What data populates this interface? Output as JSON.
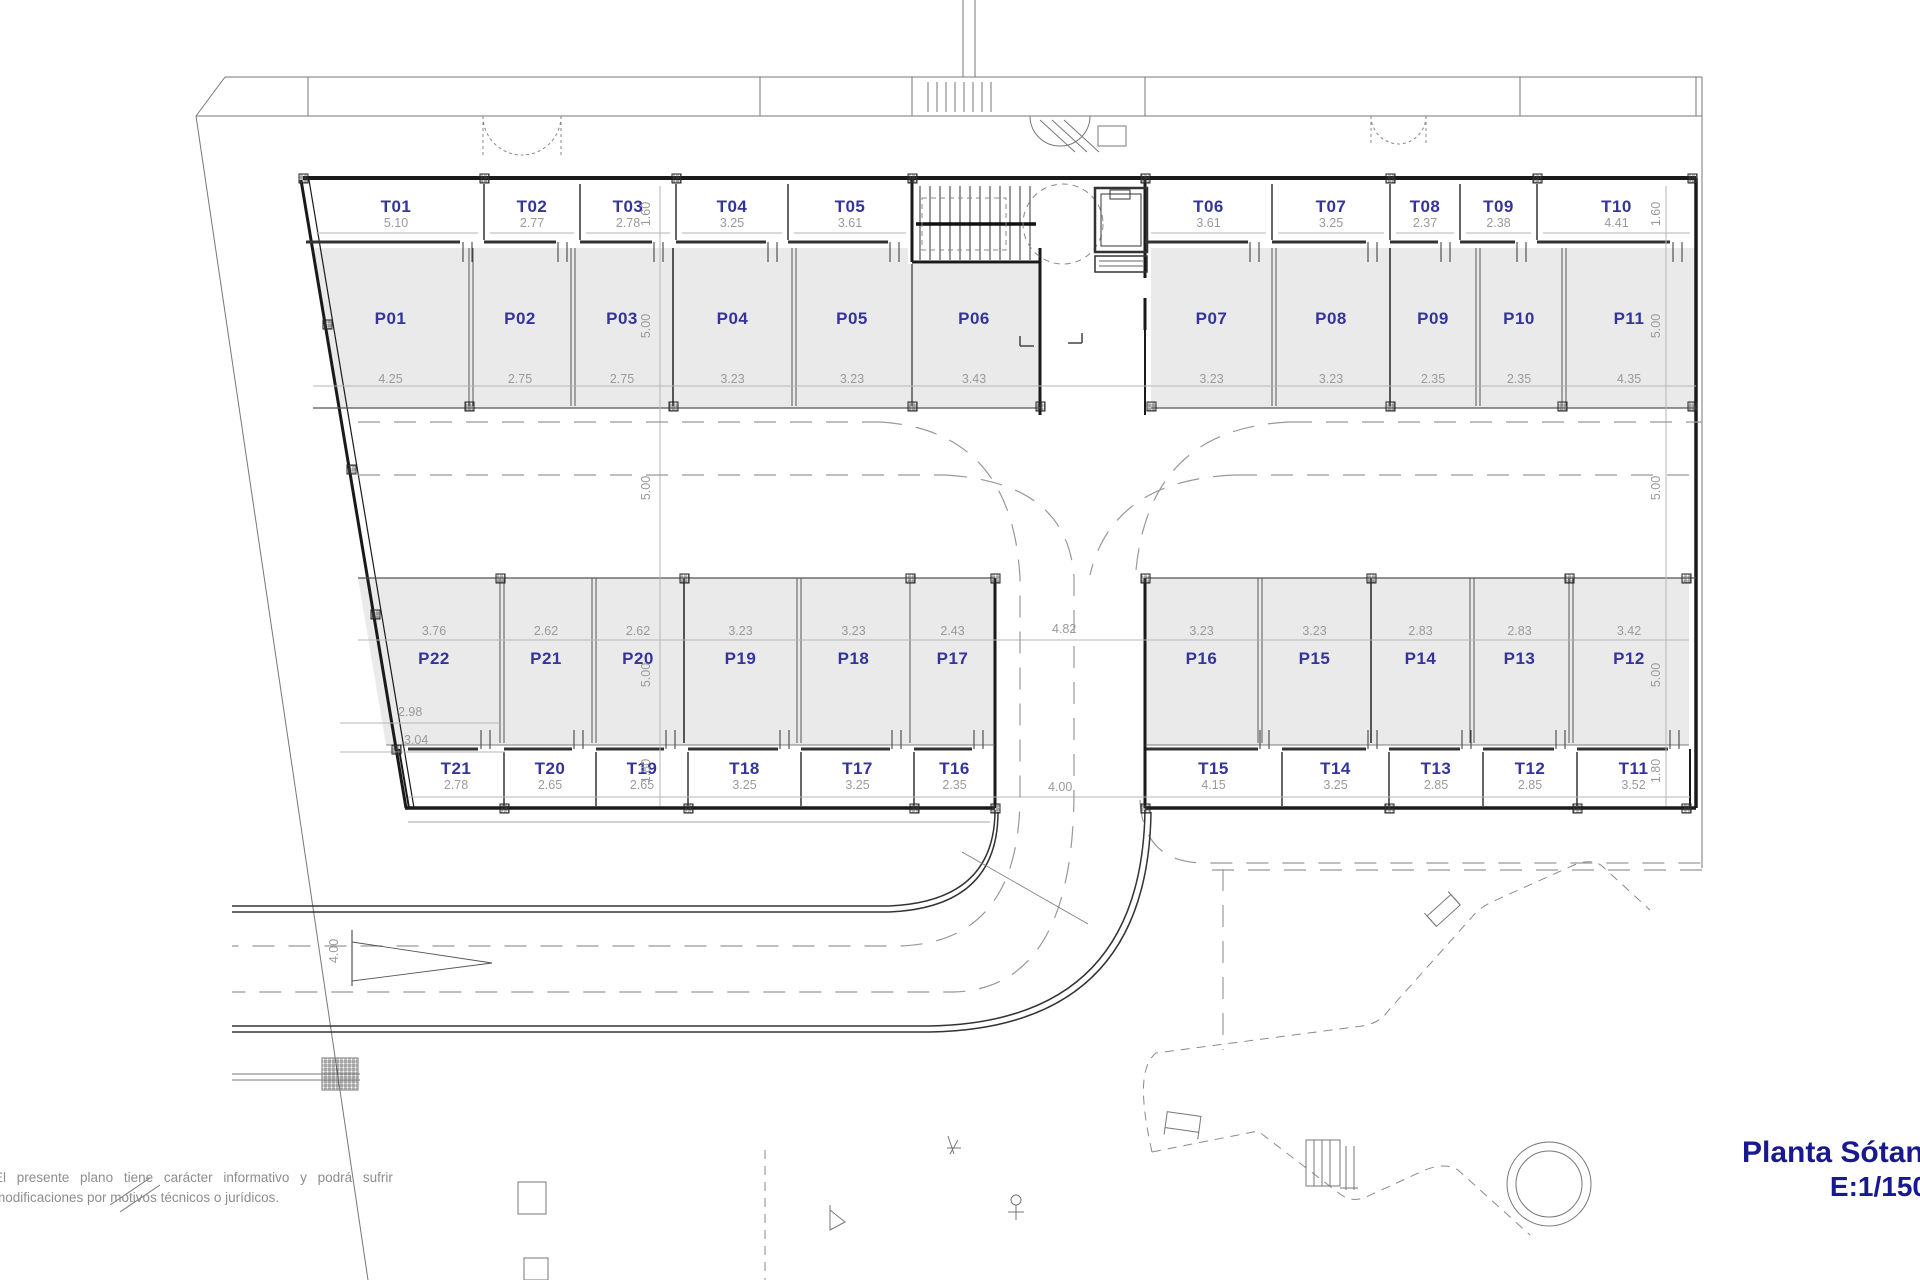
{
  "plan": {
    "title_block": {
      "name": "Planta Sótano",
      "scale": "E:1/150"
    },
    "disclaimer": {
      "line1": "El presente plano tiene carácter informativo y podrá sufrir",
      "line2": "modificaciones por motivos técnicos o jurídicos."
    },
    "colors": {
      "label": "#34349c",
      "dim": "#9a9a9a",
      "wall": "#1a1a1a",
      "stall_fill": "#eaeaea"
    },
    "top_storage": [
      {
        "id": "T01",
        "dim": "5.10"
      },
      {
        "id": "T02",
        "dim": "2.77"
      },
      {
        "id": "T03",
        "dim": "2.78"
      },
      {
        "id": "T04",
        "dim": "3.25"
      },
      {
        "id": "T05",
        "dim": "3.61"
      },
      {
        "id": "T06",
        "dim": "3.61"
      },
      {
        "id": "T07",
        "dim": "3.25"
      },
      {
        "id": "T08",
        "dim": "2.37"
      },
      {
        "id": "T09",
        "dim": "2.38"
      },
      {
        "id": "T10",
        "dim": "4.41"
      }
    ],
    "top_parking": [
      {
        "id": "P01",
        "dim": "4.25"
      },
      {
        "id": "P02",
        "dim": "2.75"
      },
      {
        "id": "P03",
        "dim": "2.75"
      },
      {
        "id": "P04",
        "dim": "3.23"
      },
      {
        "id": "P05",
        "dim": "3.23"
      },
      {
        "id": "P06",
        "dim": "3.43"
      },
      {
        "id": "P07",
        "dim": "3.23"
      },
      {
        "id": "P08",
        "dim": "3.23"
      },
      {
        "id": "P09",
        "dim": "2.35"
      },
      {
        "id": "P10",
        "dim": "2.35"
      },
      {
        "id": "P11",
        "dim": "4.35"
      }
    ],
    "bottom_parking": [
      {
        "id": "P22",
        "dim": "3.76"
      },
      {
        "id": "P21",
        "dim": "2.62"
      },
      {
        "id": "P20",
        "dim": "2.62"
      },
      {
        "id": "P19",
        "dim": "3.23"
      },
      {
        "id": "P18",
        "dim": "3.23"
      },
      {
        "id": "P17",
        "dim": "2.43"
      },
      {
        "id": "P16",
        "dim": "3.23"
      },
      {
        "id": "P15",
        "dim": "3.23"
      },
      {
        "id": "P14",
        "dim": "2.83"
      },
      {
        "id": "P13",
        "dim": "2.83"
      },
      {
        "id": "P12",
        "dim": "3.42"
      }
    ],
    "bottom_storage": [
      {
        "id": "T21",
        "dim": "2.78"
      },
      {
        "id": "T20",
        "dim": "2.65"
      },
      {
        "id": "T19",
        "dim": "2.65"
      },
      {
        "id": "T18",
        "dim": "3.25"
      },
      {
        "id": "T17",
        "dim": "3.25"
      },
      {
        "id": "T16",
        "dim": "2.35"
      },
      {
        "id": "T15",
        "dim": "4.15"
      },
      {
        "id": "T14",
        "dim": "3.25"
      },
      {
        "id": "T13",
        "dim": "2.85"
      },
      {
        "id": "T12",
        "dim": "2.85"
      },
      {
        "id": "T11",
        "dim": "3.52"
      }
    ],
    "aux_dims": {
      "p22_inner": "2.98",
      "t21_outer": "3.04",
      "bottom_gap": "4.82",
      "ramp_gap": "4.00",
      "ramp_rotated": "4.00",
      "depth_labels": [
        "1.60",
        "5.00",
        "5.00",
        "5.00",
        "1.80"
      ]
    }
  }
}
